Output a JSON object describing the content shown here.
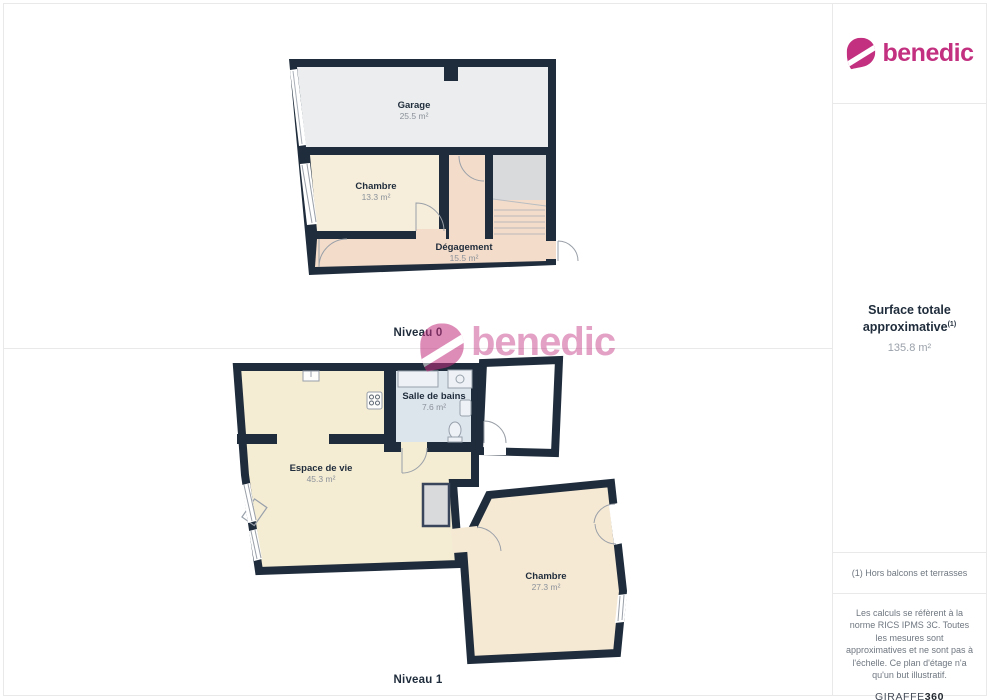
{
  "brand": {
    "name": "benedic",
    "color": "#c2307f"
  },
  "watermark": {
    "text": "benedic"
  },
  "floors": [
    {
      "id": "niveau0",
      "label": "Niveau 0",
      "rooms": [
        {
          "name": "Garage",
          "area": "25.5 m²"
        },
        {
          "name": "Chambre",
          "area": "13.3 m²"
        },
        {
          "name": "Dégagement",
          "area": "15.5 m²"
        }
      ]
    },
    {
      "id": "niveau1",
      "label": "Niveau 1",
      "rooms": [
        {
          "name": "Salle de bains",
          "area": "7.6 m²"
        },
        {
          "name": "Espace de vie",
          "area": "45.3 m²"
        },
        {
          "name": "Chambre",
          "area": "27.3 m²"
        }
      ]
    }
  ],
  "sidebar": {
    "surface_title": "Surface totale approximative",
    "surface_superscript": "(1)",
    "surface_value": "135.8 m²",
    "footnote": "(1) Hors balcons et terrasses",
    "disclaimer": "Les calculs se réfèrent à la norme RICS IPMS 3C. Toutes les mesures sont approximatives et ne sont pas à l'échelle. Ce plan d'étage n'a qu'un but illustratif.",
    "provider_name": "GIRAFFE",
    "provider_suffix": "360"
  },
  "colors": {
    "wall": "#1f2c3b",
    "garage_floor": "#ebedee",
    "cream_floor": "#f6eedb",
    "peach_floor": "#f3dcca",
    "bath_floor": "#dce4ec",
    "stair_landing": "#d9dadc",
    "brand_magenta": "#c2307f",
    "panel_border": "#e9e9e9"
  }
}
